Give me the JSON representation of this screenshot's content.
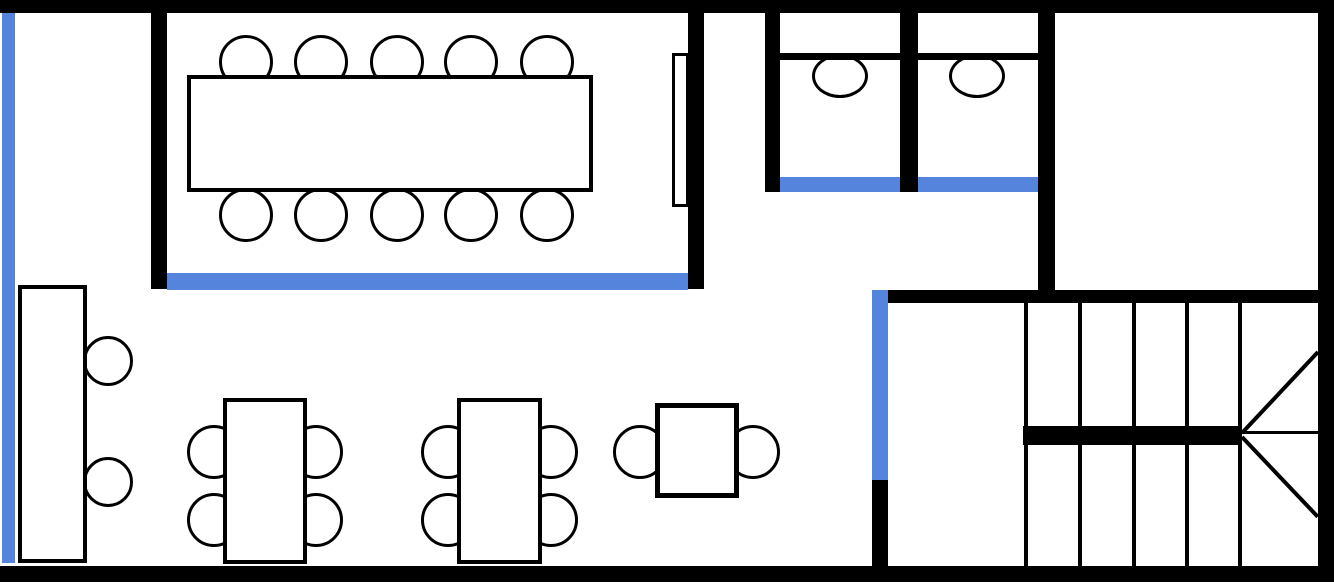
{
  "canvas": {
    "width": 1334,
    "height": 588,
    "background": "#ffffff"
  },
  "colors": {
    "wall": "#000000",
    "glass": "#5584dc",
    "paper": "#ffffff"
  },
  "shapes": [
    {
      "name": "top-wall",
      "kind": "rect",
      "x": 0,
      "y": 0,
      "w": 1334,
      "h": 13,
      "fill": "wall"
    },
    {
      "name": "bottom-wall",
      "kind": "rect",
      "x": 0,
      "y": 566,
      "w": 1334,
      "h": 16,
      "fill": "wall"
    },
    {
      "name": "right-wall",
      "kind": "rect",
      "x": 1318,
      "y": 0,
      "w": 16,
      "h": 582,
      "fill": "wall"
    },
    {
      "name": "left-glass-wall",
      "kind": "rect",
      "x": 2,
      "y": 13,
      "w": 13,
      "h": 550,
      "fill": "glass"
    },
    {
      "name": "meeting-room-left-wall",
      "kind": "rect",
      "x": 151,
      "y": 13,
      "w": 16,
      "h": 276,
      "fill": "wall"
    },
    {
      "name": "meeting-room-right-wall",
      "kind": "rect",
      "x": 688,
      "y": 13,
      "w": 16,
      "h": 276,
      "fill": "wall"
    },
    {
      "name": "meeting-room-glass-front",
      "kind": "rect",
      "x": 167,
      "y": 273,
      "w": 521,
      "h": 17,
      "fill": "glass"
    },
    {
      "name": "conference-chair-top-1",
      "kind": "circle",
      "cx": 246,
      "cy": 62,
      "r": 27,
      "fill": "paper",
      "stroke": "wall",
      "sw": 3
    },
    {
      "name": "conference-chair-top-2",
      "kind": "circle",
      "cx": 321,
      "cy": 62,
      "r": 27,
      "fill": "paper",
      "stroke": "wall",
      "sw": 3
    },
    {
      "name": "conference-chair-top-3",
      "kind": "circle",
      "cx": 397,
      "cy": 62,
      "r": 27,
      "fill": "paper",
      "stroke": "wall",
      "sw": 3
    },
    {
      "name": "conference-chair-top-4",
      "kind": "circle",
      "cx": 471,
      "cy": 62,
      "r": 27,
      "fill": "paper",
      "stroke": "wall",
      "sw": 3
    },
    {
      "name": "conference-chair-top-5",
      "kind": "circle",
      "cx": 547,
      "cy": 62,
      "r": 27,
      "fill": "paper",
      "stroke": "wall",
      "sw": 3
    },
    {
      "name": "conference-chair-bottom-1",
      "kind": "circle",
      "cx": 246,
      "cy": 215,
      "r": 27,
      "fill": "paper",
      "stroke": "wall",
      "sw": 3
    },
    {
      "name": "conference-chair-bottom-2",
      "kind": "circle",
      "cx": 321,
      "cy": 215,
      "r": 27,
      "fill": "paper",
      "stroke": "wall",
      "sw": 3
    },
    {
      "name": "conference-chair-bottom-3",
      "kind": "circle",
      "cx": 397,
      "cy": 215,
      "r": 27,
      "fill": "paper",
      "stroke": "wall",
      "sw": 3
    },
    {
      "name": "conference-chair-bottom-4",
      "kind": "circle",
      "cx": 471,
      "cy": 215,
      "r": 27,
      "fill": "paper",
      "stroke": "wall",
      "sw": 3
    },
    {
      "name": "conference-chair-bottom-5",
      "kind": "circle",
      "cx": 547,
      "cy": 215,
      "r": 27,
      "fill": "paper",
      "stroke": "wall",
      "sw": 3
    },
    {
      "name": "conference-table",
      "kind": "rect",
      "x": 187,
      "y": 75,
      "w": 406,
      "h": 117,
      "fill": "paper",
      "stroke": "wall",
      "sw": 4
    },
    {
      "name": "presentation-screen",
      "kind": "rect",
      "x": 672,
      "y": 53,
      "w": 17,
      "h": 154,
      "fill": "paper",
      "stroke": "wall",
      "sw": 3
    },
    {
      "name": "toilet-room-left-wall",
      "kind": "rect",
      "x": 765,
      "y": 13,
      "w": 15,
      "h": 179,
      "fill": "wall"
    },
    {
      "name": "toilet-stall-divider-wall",
      "kind": "rect",
      "x": 900,
      "y": 13,
      "w": 18,
      "h": 179,
      "fill": "wall"
    },
    {
      "name": "toilet-room-right-wall",
      "kind": "rect",
      "x": 1038,
      "y": 13,
      "w": 17,
      "h": 290,
      "fill": "wall"
    },
    {
      "name": "toilet-bowl-1",
      "kind": "ellipse",
      "x": 812,
      "y": 54,
      "w": 56,
      "h": 44,
      "fill": "paper",
      "stroke": "wall",
      "sw": 3
    },
    {
      "name": "toilet-bowl-2",
      "kind": "ellipse",
      "x": 949,
      "y": 54,
      "w": 56,
      "h": 44,
      "fill": "paper",
      "stroke": "wall",
      "sw": 3
    },
    {
      "name": "toilet-tank-line-1",
      "kind": "rect",
      "x": 780,
      "y": 53,
      "w": 120,
      "h": 7,
      "fill": "wall"
    },
    {
      "name": "toilet-tank-line-2",
      "kind": "rect",
      "x": 918,
      "y": 53,
      "w": 120,
      "h": 7,
      "fill": "wall"
    },
    {
      "name": "toilet-stall-door-1",
      "kind": "rect",
      "x": 780,
      "y": 177,
      "w": 120,
      "h": 15,
      "fill": "glass"
    },
    {
      "name": "toilet-stall-door-2",
      "kind": "rect",
      "x": 918,
      "y": 177,
      "w": 120,
      "h": 15,
      "fill": "glass"
    },
    {
      "name": "stair-room-top-wall",
      "kind": "rect",
      "x": 888,
      "y": 290,
      "w": 446,
      "h": 13,
      "fill": "wall"
    },
    {
      "name": "stair-room-glass-door",
      "kind": "rect",
      "x": 872,
      "y": 290,
      "w": 16,
      "h": 190,
      "fill": "glass"
    },
    {
      "name": "stair-room-left-wall",
      "kind": "rect",
      "x": 872,
      "y": 480,
      "w": 16,
      "h": 86,
      "fill": "wall"
    },
    {
      "name": "stair-tread-upper-1",
      "kind": "rect",
      "x": 1024,
      "y": 303,
      "w": 4,
      "h": 123,
      "fill": "wall"
    },
    {
      "name": "stair-tread-upper-2",
      "kind": "rect",
      "x": 1078,
      "y": 303,
      "w": 4,
      "h": 123,
      "fill": "wall"
    },
    {
      "name": "stair-tread-upper-3",
      "kind": "rect",
      "x": 1132,
      "y": 303,
      "w": 4,
      "h": 123,
      "fill": "wall"
    },
    {
      "name": "stair-tread-upper-4",
      "kind": "rect",
      "x": 1185,
      "y": 303,
      "w": 4,
      "h": 123,
      "fill": "wall"
    },
    {
      "name": "stair-tread-upper-5",
      "kind": "rect",
      "x": 1238,
      "y": 303,
      "w": 4,
      "h": 123,
      "fill": "wall"
    },
    {
      "name": "stair-landing-edge",
      "kind": "rect",
      "x": 1023,
      "y": 426,
      "w": 219,
      "h": 19,
      "fill": "wall"
    },
    {
      "name": "stair-tread-lower-1",
      "kind": "rect",
      "x": 1024,
      "y": 445,
      "w": 4,
      "h": 121,
      "fill": "wall"
    },
    {
      "name": "stair-tread-lower-2",
      "kind": "rect",
      "x": 1078,
      "y": 445,
      "w": 4,
      "h": 121,
      "fill": "wall"
    },
    {
      "name": "stair-tread-lower-3",
      "kind": "rect",
      "x": 1132,
      "y": 445,
      "w": 4,
      "h": 121,
      "fill": "wall"
    },
    {
      "name": "stair-tread-lower-4",
      "kind": "rect",
      "x": 1185,
      "y": 445,
      "w": 4,
      "h": 121,
      "fill": "wall"
    },
    {
      "name": "stair-tread-lower-5",
      "kind": "rect",
      "x": 1238,
      "y": 445,
      "w": 4,
      "h": 121,
      "fill": "wall"
    },
    {
      "name": "stair-winder-edge-mid",
      "kind": "line",
      "x1": 1242,
      "y1": 432,
      "x2": 1318,
      "y2": 432,
      "sw": 3,
      "stroke": "wall"
    },
    {
      "name": "stair-winder-edge-upper",
      "kind": "line",
      "x1": 1242,
      "y1": 433,
      "x2": 1318,
      "y2": 352,
      "sw": 4,
      "stroke": "wall"
    },
    {
      "name": "stair-winder-edge-lower",
      "kind": "line",
      "x1": 1242,
      "y1": 437,
      "x2": 1318,
      "y2": 517,
      "sw": 4,
      "stroke": "wall"
    },
    {
      "name": "desk-chair-1",
      "kind": "circle",
      "cx": 108,
      "cy": 361,
      "r": 25,
      "fill": "paper",
      "stroke": "wall",
      "sw": 3
    },
    {
      "name": "desk-chair-2",
      "kind": "circle",
      "cx": 108,
      "cy": 482,
      "r": 25,
      "fill": "paper",
      "stroke": "wall",
      "sw": 3
    },
    {
      "name": "long-desk",
      "kind": "rect",
      "x": 18,
      "y": 285,
      "w": 69,
      "h": 278,
      "fill": "paper",
      "stroke": "wall",
      "sw": 4
    },
    {
      "name": "work-table-1-chair-1",
      "kind": "circle",
      "cx": 214,
      "cy": 452,
      "r": 27,
      "fill": "paper",
      "stroke": "wall",
      "sw": 3
    },
    {
      "name": "work-table-1-chair-2",
      "kind": "circle",
      "cx": 214,
      "cy": 520,
      "r": 27,
      "fill": "paper",
      "stroke": "wall",
      "sw": 3
    },
    {
      "name": "work-table-1-chair-3",
      "kind": "circle",
      "cx": 316,
      "cy": 452,
      "r": 27,
      "fill": "paper",
      "stroke": "wall",
      "sw": 3
    },
    {
      "name": "work-table-1-chair-4",
      "kind": "circle",
      "cx": 316,
      "cy": 520,
      "r": 27,
      "fill": "paper",
      "stroke": "wall",
      "sw": 3
    },
    {
      "name": "work-table-1",
      "kind": "rect",
      "x": 223,
      "y": 398,
      "w": 84,
      "h": 166,
      "fill": "paper",
      "stroke": "wall",
      "sw": 4
    },
    {
      "name": "work-table-2-chair-1",
      "kind": "circle",
      "cx": 448,
      "cy": 452,
      "r": 27,
      "fill": "paper",
      "stroke": "wall",
      "sw": 3
    },
    {
      "name": "work-table-2-chair-2",
      "kind": "circle",
      "cx": 448,
      "cy": 520,
      "r": 27,
      "fill": "paper",
      "stroke": "wall",
      "sw": 3
    },
    {
      "name": "work-table-2-chair-3",
      "kind": "circle",
      "cx": 551,
      "cy": 452,
      "r": 27,
      "fill": "paper",
      "stroke": "wall",
      "sw": 3
    },
    {
      "name": "work-table-2-chair-4",
      "kind": "circle",
      "cx": 551,
      "cy": 520,
      "r": 27,
      "fill": "paper",
      "stroke": "wall",
      "sw": 3
    },
    {
      "name": "work-table-2",
      "kind": "rect",
      "x": 457,
      "y": 398,
      "w": 85,
      "h": 166,
      "fill": "paper",
      "stroke": "wall",
      "sw": 4
    },
    {
      "name": "side-table-chair-1",
      "kind": "circle",
      "cx": 640,
      "cy": 452,
      "r": 27,
      "fill": "paper",
      "stroke": "wall",
      "sw": 3
    },
    {
      "name": "side-table-chair-2",
      "kind": "circle",
      "cx": 753,
      "cy": 452,
      "r": 27,
      "fill": "paper",
      "stroke": "wall",
      "sw": 3
    },
    {
      "name": "side-table",
      "kind": "rect",
      "x": 655,
      "y": 403,
      "w": 84,
      "h": 95,
      "fill": "paper",
      "stroke": "wall",
      "sw": 5
    }
  ]
}
